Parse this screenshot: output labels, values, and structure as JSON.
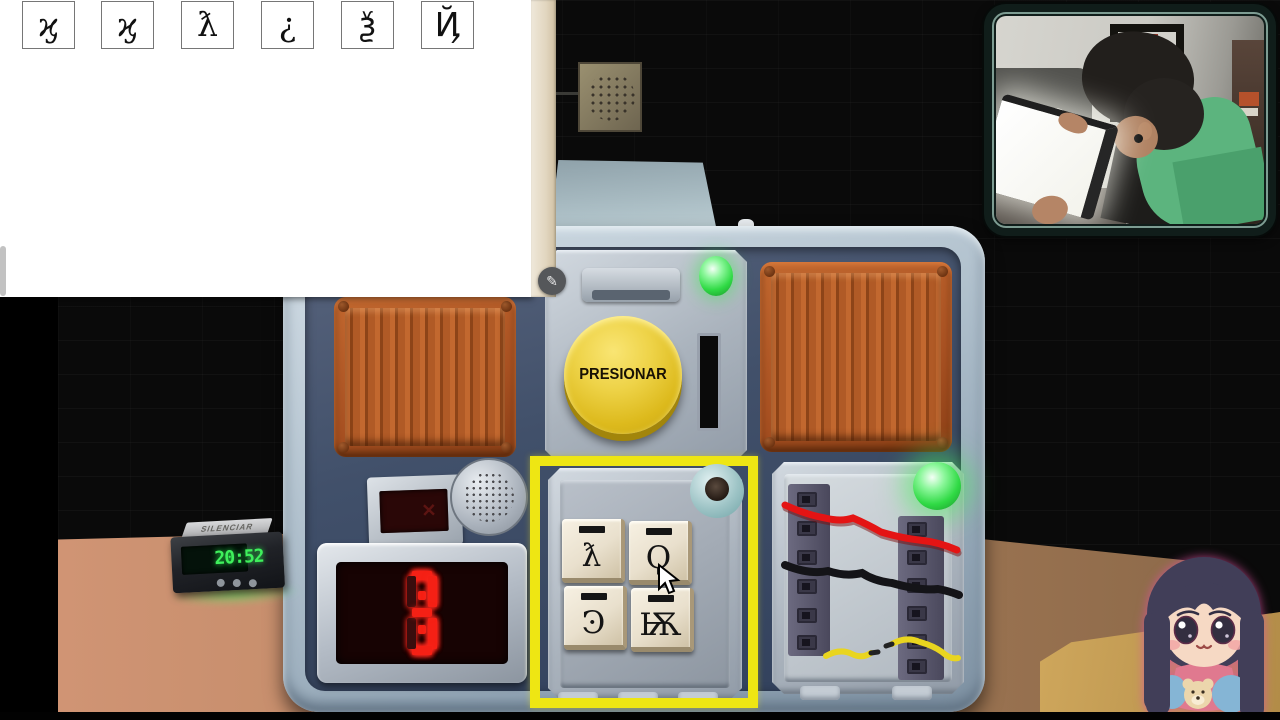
{
  "manual_page": {
    "symbol_table": {
      "rows": [
        [
          "Ϙ",
          "Ӭ",
          "©",
          "б",
          "Ψ",
          "б"
        ],
        [
          "Ѧ",
          "Ϙ",
          "Ѽ",
          "¶",
          "ټ",
          "Ӭ"
        ],
        [
          "ƛ",
          "Ͽ",
          "Ҩ",
          "Ѣ",
          "Ѣ",
          "✶"
        ],
        [
          "Ϟ",
          "Ҩ",
          "Җ",
          "Ѭ",
          "Ͼ",
          "æ"
        ],
        [
          "Ѭ",
          "☆",
          "Ѯ",
          "Җ",
          "¶",
          "Ψ"
        ],
        [
          "ϗ",
          "ϗ",
          "ƛ",
          "¿",
          "ѯ",
          "Ҋ"
        ]
      ]
    }
  },
  "annotation_tool": {
    "pencil_icon": "✎"
  },
  "bomb": {
    "button_module": {
      "label": "PRESIONAR",
      "button_color": "#e8c822",
      "led_color": "#3de44e"
    },
    "timer_module": {
      "time": "03:03",
      "digit_color": "#f52015",
      "strikes": "✕ ✕"
    },
    "keypad_module": {
      "selected": true,
      "selection_color": "#eee613",
      "keys": [
        "ƛ",
        "Ϙ",
        "Ͽ",
        "Ѭ"
      ]
    },
    "wires_module": {
      "led_color": "#3de44e",
      "wires": [
        {
          "name": "red wire",
          "hex": "#e41414",
          "cut": false
        },
        {
          "name": "black wire",
          "hex": "#141418",
          "cut": false
        },
        {
          "name": "yellow wire",
          "hex": "#e9d51f",
          "cut": true
        }
      ]
    }
  },
  "desk": {
    "clock": {
      "time": "20:52",
      "snooze_label": "SILENCIAR",
      "digit_color": "#3ff05c"
    }
  }
}
